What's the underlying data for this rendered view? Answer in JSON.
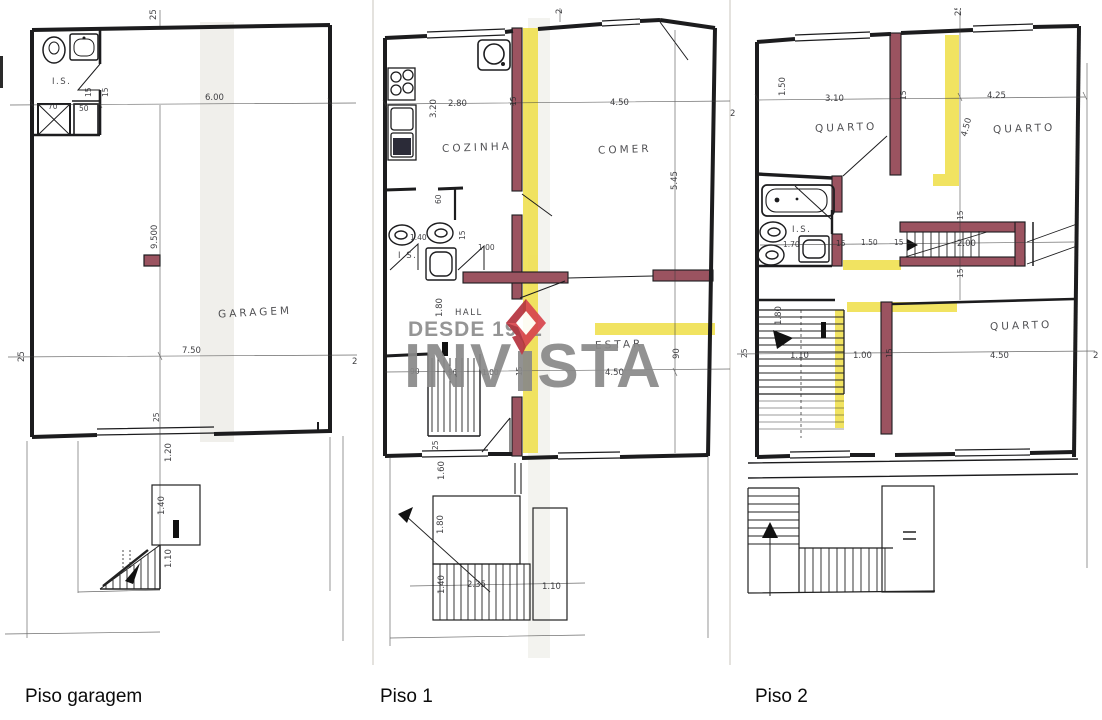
{
  "captions": {
    "garagem": "Piso garagem",
    "piso1": "Piso 1",
    "piso2": "Piso 2"
  },
  "watermark": {
    "tagline": "DESDE 1992",
    "brand_pre": "INV",
    "brand_post": "STA"
  },
  "colors": {
    "wall_black": "#1c1c1e",
    "wall_maroon": "#9b5360",
    "highlight_yellow": "#f0e050",
    "watermark_gray": "#898989",
    "logo_red": "#d8454e",
    "logo_red_dark": "#b5333e"
  },
  "garagem": {
    "rooms": {
      "is": "I.S.",
      "garagem": "GARAGEM"
    },
    "dims": {
      "top": "25",
      "width": "6.00",
      "shower_w": "70",
      "shower_d": "50",
      "wall_a": "15",
      "wall_b": "15",
      "depth": "9.500",
      "bottom_width": "7.50",
      "left": "25",
      "right": "2",
      "door": "25",
      "stair_a": "1.20",
      "stair_b": "1.40",
      "stair_c": "1.10"
    }
  },
  "piso1": {
    "rooms": {
      "cozinha": "COZINHA",
      "comer": "COMER",
      "is": "I.S.",
      "hall": "HALL",
      "estar": "ESTAR"
    },
    "dims": {
      "top": "25",
      "koz_h": "3.20",
      "koz_w": "2.80",
      "wall": "15",
      "comer_w": "4.50",
      "comer_h": "5.45",
      "right": "2",
      "door": "60",
      "is_w": "1.40",
      "is_wall": "15",
      "hall_w": "1.00",
      "hall_h": "1.80",
      "stair_a": "90",
      "stair_b": "90",
      "stair_c": "1.00",
      "stair_wall": "15",
      "estar_w": "4.50",
      "estar_h": "90",
      "b25": "25",
      "b160": "1.60",
      "b180": "1.80",
      "b235": "2.35",
      "b110": "1.10",
      "b140": "1.40"
    }
  },
  "piso2": {
    "rooms": {
      "q1": "QUARTO",
      "q2": "QUARTO",
      "is": "I.S.",
      "q3": "QUARTO"
    },
    "dims": {
      "top": "25",
      "left_h": "1.50",
      "q1_w": "3.10",
      "wall": "15",
      "q2_w": "4.25",
      "mid_h": "4.50",
      "is_a": "1.70",
      "is_b": "15",
      "is_c": "1.50",
      "is_d": "15",
      "corr": "2.00",
      "corr_wall_a": "15",
      "corr_wall_b": "15",
      "stair_h": "1.80",
      "left": "25",
      "st_a": "1.10",
      "st_b": "1.00",
      "st_c": "15",
      "q3_w": "4.50",
      "right": "2"
    }
  }
}
